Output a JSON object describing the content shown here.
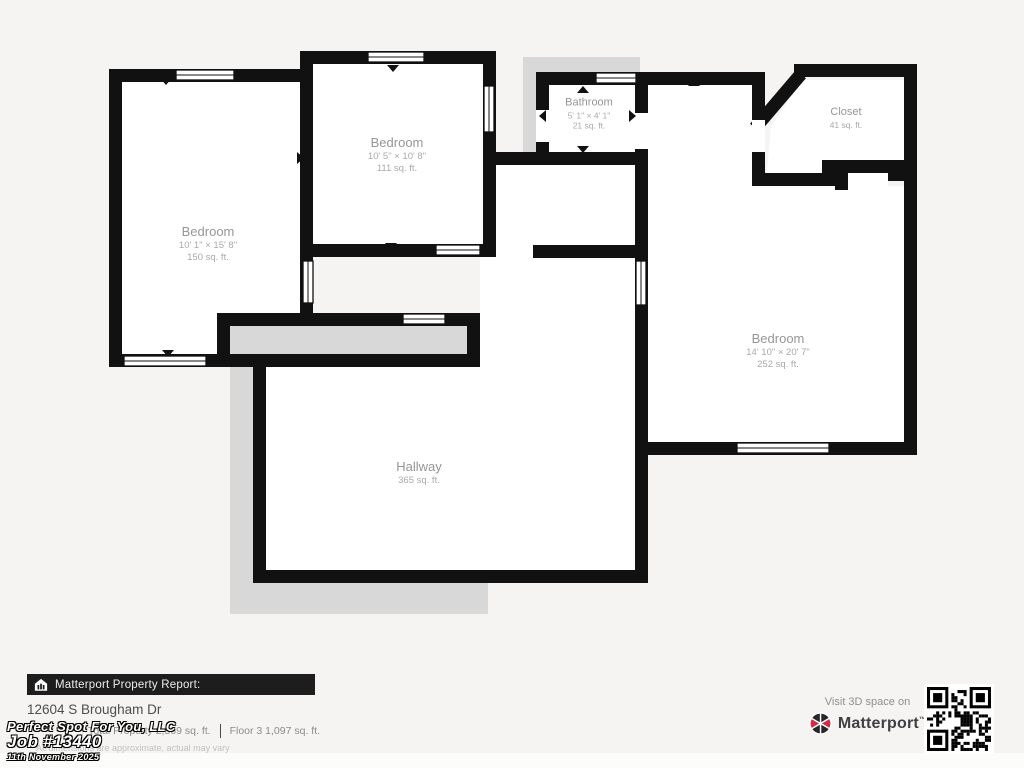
{
  "colors": {
    "wall": "#111111",
    "void_gray": "#d8d8d8",
    "brand_red": "#d22b4a"
  },
  "rooms": [
    {
      "name": "Bedroom",
      "dims": "10' 1\" × 15' 8\"",
      "area": "150 sq. ft."
    },
    {
      "name": "Bedroom",
      "dims": "10' 5\" × 10' 8\"",
      "area": "111 sq. ft."
    },
    {
      "name": "Bathroom",
      "dims": "5' 1\" × 4' 1\"",
      "area": "21 sq. ft."
    },
    {
      "name": "Closet",
      "dims": "",
      "area": "41 sq. ft."
    },
    {
      "name": "Bedroom",
      "dims": "14' 10\" × 20' 7\"",
      "area": "252 sq. ft."
    },
    {
      "name": "Hallway",
      "dims": "",
      "area": "365 sq. ft."
    }
  ],
  "footer": {
    "report_label": "Matterport Property Report:",
    "address": "12604 S Brougham Dr",
    "stat_total": "Total Property 2,569 sq. ft.",
    "stat_floor": "Floor 3 1,097 sq. ft.",
    "disclaimer": "All dimensions are approximate, actual may vary",
    "visit_label": "Visit 3D space on",
    "brand": "Matterport"
  },
  "watermark": {
    "company": "Perfect Spot For You, LLC",
    "job": "Job #13440",
    "date": "11th November 2025"
  }
}
